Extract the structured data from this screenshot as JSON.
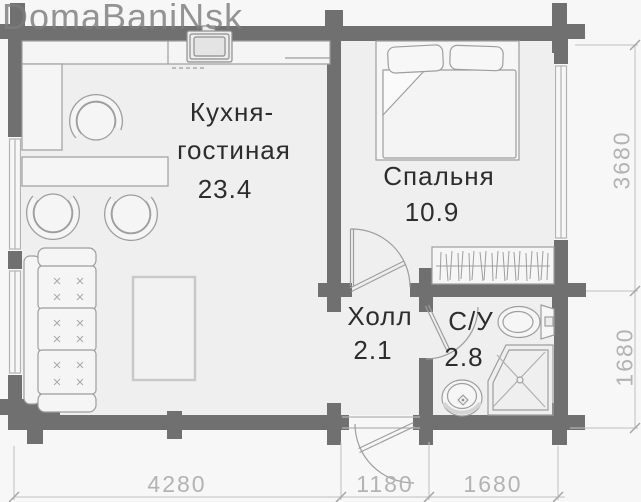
{
  "watermark": "DomaBaniNsk",
  "rooms": [
    {
      "id": "kitchen-living",
      "label_line1": "Кухня-",
      "label_line2": "гостиная",
      "area": "23.4"
    },
    {
      "id": "bedroom",
      "label": "Спальня",
      "area": "10.9"
    },
    {
      "id": "hall",
      "label": "Холл",
      "area": "2.1"
    },
    {
      "id": "bathroom",
      "label": "С/У",
      "area": "2.8"
    }
  ],
  "dimensions_mm": {
    "bottom": [
      "4280",
      "1180",
      "1680"
    ],
    "right": [
      "3680",
      "1680"
    ]
  },
  "fixtures": [
    "kitchen-counter",
    "kitchen-sink",
    "kitchen-chair",
    "dining-table",
    "dining-chair",
    "sofa",
    "coffee-table",
    "double-bed",
    "wardrobe",
    "toilet",
    "washbasin",
    "shower-cabin",
    "window",
    "interior-door",
    "entrance-door"
  ],
  "colors": {
    "wall": "#707070",
    "floor": "#efefef",
    "furniture_line": "#9e9e9e",
    "dimension_text": "#b3b3b3",
    "label_text": "#2d2d2d",
    "watermark": "#8a8a8a"
  }
}
